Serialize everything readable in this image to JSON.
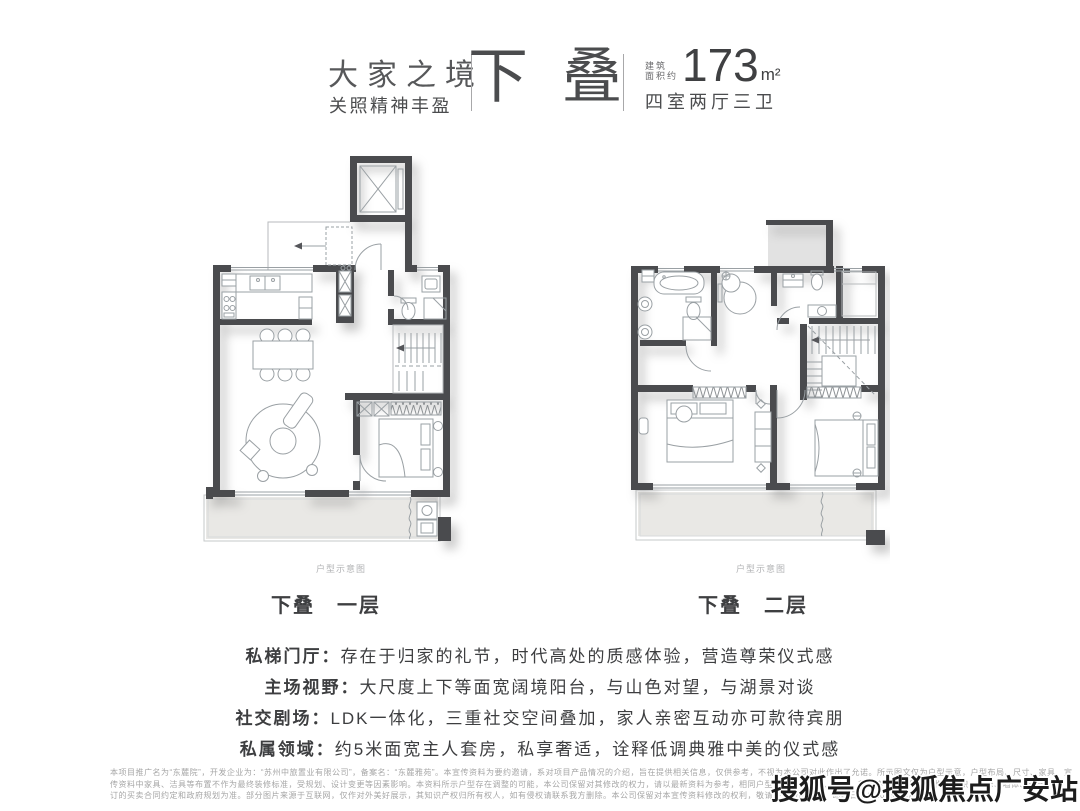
{
  "header": {
    "brand_title": "大家之境",
    "brand_subtitle": "关照精神丰盈",
    "type_char_1": "下",
    "type_char_2": "叠",
    "area_prefix_line1": "建筑",
    "area_prefix_line2": "面积约",
    "area_value": "173",
    "area_unit": "m²",
    "layout_spec": "四室两厅三卫"
  },
  "plans": {
    "level1": {
      "label": "下叠　一层",
      "caption": "户型示意图"
    },
    "level2": {
      "label": "下叠　二层",
      "caption": "户型示意图"
    }
  },
  "features": [
    {
      "title": "私梯门厅：",
      "text": "存在于归家的礼节，时代高处的质感体验，营造尊荣仪式感"
    },
    {
      "title": "主场视野：",
      "text": "大尺度上下等面宽阔境阳台，与山色对望，与湖景对谈"
    },
    {
      "title": "社交剧场：",
      "text": "LDK一体化，三重社交空间叠加，家人亲密互动亦可款待宾朋"
    },
    {
      "title": "私属领域：",
      "text": "约5米面宽主人套房，私享奢适，诠释低调典雅中美的仪式感"
    }
  ],
  "disclaimer": {
    "line1": "本项目推广名为“东麓院”，开发企业为：“苏州中旅置业有限公司”，备案名：“东麓雅苑”。本宣传资料为要约邀请，系对项目产品情况的介绍，旨在提供相关信息，仅供参考，不视为本公司对此作出了允诺。所示图文仅为户型示意，户型布局、尺寸、家具、宣",
    "line2": "传资料中家具、洁具等布置不作为最终装修标准，受规划、设计变更等因素影响。本资料所示户型存在调整的可能，本公司保留对其修改的权力，请以最新资料为参考，相同户型因楼栋、楼层、单元、朝向等不同，局部结构、面积、装修、墙体、空调机位",
    "line3": "订的买卖合同约定和政府规划为准。部分图片来源于互联网，仅作对外美好展示，其知识产权归所有权人，如有侵权请联系我方删除。本公司保留对本宣传资料修改的权利，敬请关注最新资料。印刷日期：2023年8月。"
  },
  "watermark": "搜狐号@搜狐焦点广安站",
  "colors": {
    "wall": "#4a4b4e",
    "balcony_fill": "#e9e8e5",
    "void_fill": "#e2e2e2",
    "text_dark": "#3d3e40",
    "text_light": "#a6a6a6"
  }
}
